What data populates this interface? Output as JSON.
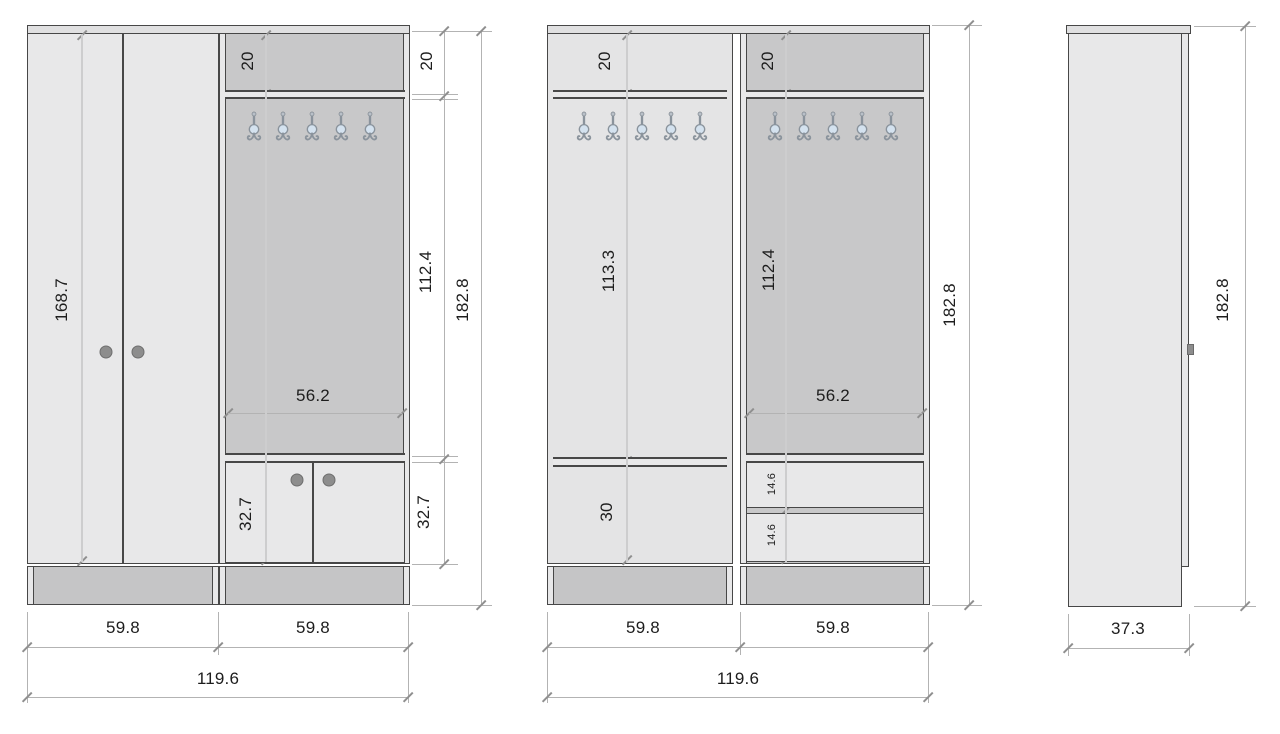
{
  "colors": {
    "outline": "#474747",
    "dim-line": "#b3b3b3",
    "tick": "#8f8f8f",
    "chain-line": "#cdcdce",
    "panel-light": "#e8e8e9",
    "panel-mid": "#e4e4e5",
    "panel-dark": "#c8c8c9",
    "board": "#e0e0e1",
    "plinth": "#c5c5c6",
    "knob": "#8d8d8d",
    "hook-metal": "#8a939c",
    "hook-accent": "#d4e2ef",
    "text": "#1d1d1d",
    "bg": "#ffffff"
  },
  "front_view": {
    "door_height": "168.7",
    "top_shelf_height": "20",
    "panel_width": "56.2",
    "lower_cabinet_height": "32.7",
    "chain": {
      "top": "20",
      "middle": "112.4",
      "bottom": "32.7",
      "total": "182.8"
    },
    "widths": {
      "left": "59.8",
      "right": "59.8",
      "total": "119.6"
    }
  },
  "interior_view": {
    "left_section": {
      "top_shelf_height": "20",
      "hook_section_height": "113.3",
      "lower_compartment_height": "30"
    },
    "right_section": {
      "top_shelf_height": "20",
      "hook_section_height": "112.4",
      "panel_width": "56.2",
      "drawer_height_1": "14.6",
      "drawer_height_2": "14.6"
    },
    "total_height": "182.8",
    "widths": {
      "left": "59.8",
      "right": "59.8",
      "total": "119.6"
    }
  },
  "side_view": {
    "total_height": "182.8",
    "depth": "37.3"
  },
  "hooks": {
    "per_section": 5,
    "sections_with_hooks": 3
  }
}
